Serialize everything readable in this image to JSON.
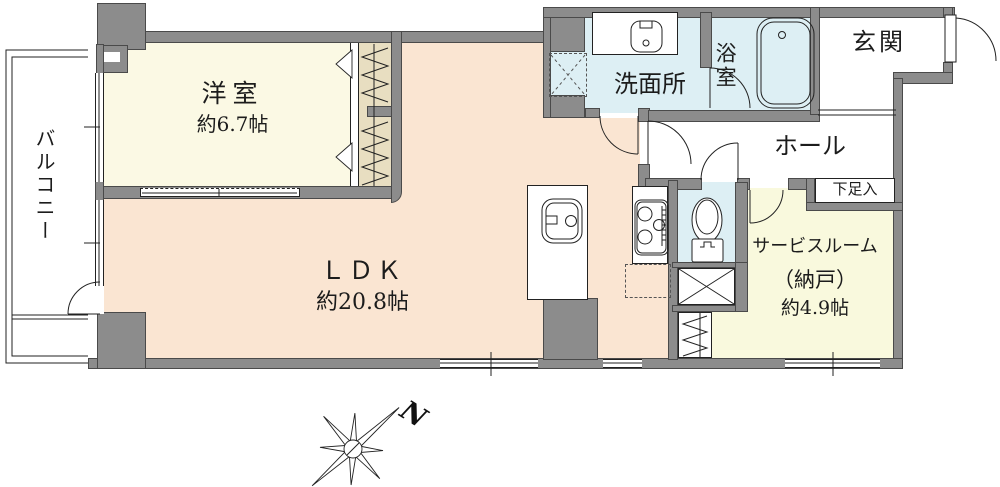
{
  "rooms": {
    "balcony": {
      "name": "バルコニー"
    },
    "western_room": {
      "name": "洋室",
      "area": "約6.7帖"
    },
    "ldk": {
      "name": "ＬＤＫ",
      "area": "約20.8帖"
    },
    "washroom": {
      "name": "洗面所"
    },
    "bathroom": {
      "name": "浴室"
    },
    "entrance": {
      "name": "玄関"
    },
    "hall": {
      "name": "ホール"
    },
    "shoe_cabinet": {
      "name": "下足入"
    },
    "service_room": {
      "name": "サービスルーム",
      "name2": "（納戸）",
      "area": "約4.9帖"
    }
  },
  "compass": {
    "north_label": "N"
  },
  "fixtures": [
    "bathtub",
    "vanity-sink",
    "washing-machine-space",
    "kitchen-sink",
    "gas-stove",
    "refrigerator-space",
    "toilet",
    "pipe-space-x",
    "futon-closet",
    "balcony-door",
    "entry-door"
  ],
  "colors": {
    "wall": "#8c8c8c",
    "wall_outline": "#4a4a4a",
    "ldk_floor": "#fae5d2",
    "western_room_floor": "#fbf9e4",
    "service_room_floor": "#f9f9dd",
    "wet_area_floor": "#ddeff4",
    "closet_fill": "#e8dec1",
    "line": "#222222"
  }
}
